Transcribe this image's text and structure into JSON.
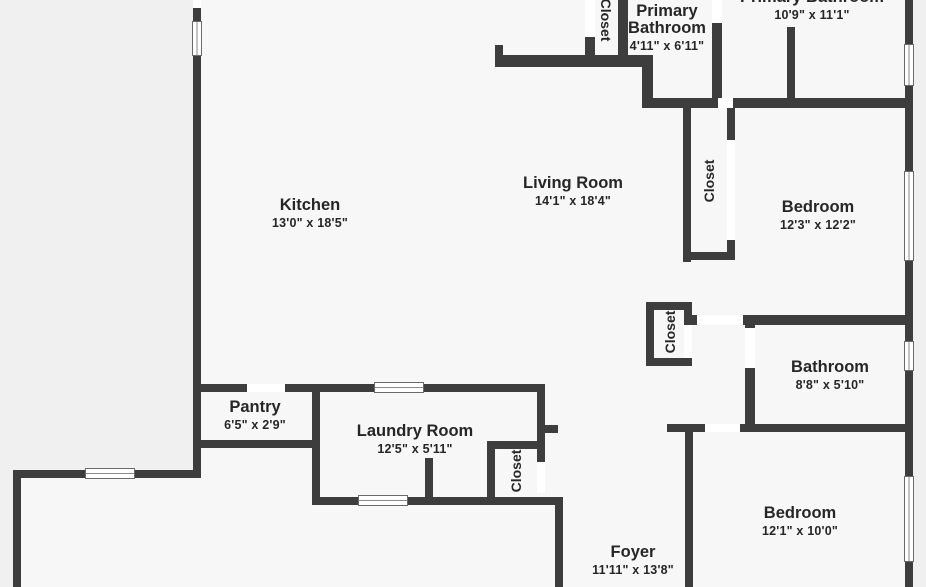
{
  "plan": {
    "colors": {
      "wall": "#3d3d3d",
      "floor": "#f7f7f7",
      "background": "#f0f0f0",
      "door_gap": "#ffffff",
      "window_frame": "#6a6a6a",
      "label_text": "#262626"
    },
    "floor_areas": [
      {
        "name": "floor-main",
        "x": 193,
        "y": 0,
        "w": 720,
        "h": 587
      },
      {
        "name": "floor-lower-left-extension",
        "x": 13,
        "y": 470,
        "w": 188,
        "h": 117
      }
    ],
    "rooms": [
      {
        "name": "room-label-kitchen",
        "lines": [
          "Kitchen"
        ],
        "dims": "13'0\" x 18'5\"",
        "cx": 310,
        "top": 197
      },
      {
        "name": "room-label-living-room",
        "lines": [
          "Living Room"
        ],
        "dims": "14'1\" x 18'4\"",
        "cx": 573,
        "top": 175
      },
      {
        "name": "room-label-primary-bathroom-small",
        "lines": [
          "Primary",
          "Bathroom"
        ],
        "dims": "4'11\" x 6'11\"",
        "cx": 667,
        "top": 3
      },
      {
        "name": "room-label-primary-bathroom-large",
        "lines": [
          "Primary Bathroom"
        ],
        "dims": "10'9\" x 11'1\"",
        "cx": 812,
        "top": -11
      },
      {
        "name": "room-label-bedroom-1",
        "lines": [
          "Bedroom"
        ],
        "dims": "12'3\" x 12'2\"",
        "cx": 818,
        "top": 199
      },
      {
        "name": "room-label-bathroom",
        "lines": [
          "Bathroom"
        ],
        "dims": "8'8\" x 5'10\"",
        "cx": 830,
        "top": 359
      },
      {
        "name": "room-label-bedroom-2",
        "lines": [
          "Bedroom"
        ],
        "dims": "12'1\" x 10'0\"",
        "cx": 800,
        "top": 505
      },
      {
        "name": "room-label-foyer",
        "lines": [
          "Foyer"
        ],
        "dims": "11'11\" x 13'8\"",
        "cx": 633,
        "top": 544
      },
      {
        "name": "room-label-pantry",
        "lines": [
          "Pantry"
        ],
        "dims": "6'5\" x 2'9\"",
        "cx": 255,
        "top": 399
      },
      {
        "name": "room-label-laundry-room",
        "lines": [
          "Laundry Room"
        ],
        "dims": "12'5\" x 5'11\"",
        "cx": 415,
        "top": 423
      }
    ],
    "closets": [
      {
        "name": "closet-label-top",
        "label": "Closet",
        "cx": 606,
        "cy": 20,
        "rotation": "cw"
      },
      {
        "name": "closet-label-hall",
        "label": "Closet",
        "cx": 709,
        "cy": 181,
        "rotation": "ccw"
      },
      {
        "name": "closet-label-middle",
        "label": "Closet",
        "cx": 670,
        "cy": 332,
        "rotation": "ccw"
      },
      {
        "name": "closet-label-laundry",
        "label": "Closet",
        "cx": 516,
        "cy": 471,
        "rotation": "ccw"
      }
    ],
    "walls": [
      {
        "name": "wall-left-upper-stub",
        "x": 193,
        "y": 8,
        "w": 8,
        "h": 14
      },
      {
        "name": "wall-left-main",
        "x": 193,
        "y": 55,
        "w": 8,
        "h": 423
      },
      {
        "name": "wall-exterior-bottom-left",
        "x": 13,
        "y": 470,
        "w": 188,
        "h": 8
      },
      {
        "name": "wall-exterior-far-left",
        "x": 13,
        "y": 470,
        "w": 8,
        "h": 117
      },
      {
        "name": "wall-right-exterior",
        "x": 905,
        "y": 0,
        "w": 8,
        "h": 587
      },
      {
        "name": "wall-top-closet-left",
        "x": 585,
        "y": 37,
        "w": 10,
        "h": 21
      },
      {
        "name": "wall-top-closet-right",
        "x": 618,
        "y": 0,
        "w": 10,
        "h": 57
      },
      {
        "name": "wall-primary-bath-divider-h",
        "x": 495,
        "y": 55,
        "w": 150,
        "h": 12
      },
      {
        "name": "wall-primary-bath-divider-stub",
        "x": 495,
        "y": 45,
        "w": 8,
        "h": 12
      },
      {
        "name": "wall-primary-bath-left",
        "x": 642,
        "y": 55,
        "w": 11,
        "h": 43
      },
      {
        "name": "wall-upper-h-1",
        "x": 642,
        "y": 98,
        "w": 76,
        "h": 10
      },
      {
        "name": "wall-upper-h-2",
        "x": 733,
        "y": 98,
        "w": 180,
        "h": 10
      },
      {
        "name": "wall-primary-suite-divider-1",
        "x": 712,
        "y": 23,
        "w": 10,
        "h": 75
      },
      {
        "name": "wall-primary-suite-divider-2",
        "x": 787,
        "y": 27,
        "w": 8,
        "h": 71
      },
      {
        "name": "wall-hall-closet-left",
        "x": 683,
        "y": 108,
        "w": 8,
        "h": 154
      },
      {
        "name": "wall-hall-closet-right-upper",
        "x": 727,
        "y": 108,
        "w": 8,
        "h": 32
      },
      {
        "name": "wall-hall-closet-right-lower",
        "x": 727,
        "y": 240,
        "w": 8,
        "h": 20
      },
      {
        "name": "wall-hall-closet-bottom",
        "x": 683,
        "y": 252,
        "w": 52,
        "h": 8
      },
      {
        "name": "wall-bedroom1-bottom-1",
        "x": 688,
        "y": 315,
        "w": 9,
        "h": 10
      },
      {
        "name": "wall-bedroom1-bottom-2",
        "x": 743,
        "y": 315,
        "w": 170,
        "h": 10
      },
      {
        "name": "wall-bathroom-left-upper",
        "x": 745,
        "y": 315,
        "w": 10,
        "h": 13
      },
      {
        "name": "wall-bathroom-left-lower",
        "x": 745,
        "y": 368,
        "w": 10,
        "h": 64
      },
      {
        "name": "wall-mid-closet-top",
        "x": 646,
        "y": 302,
        "w": 46,
        "h": 8
      },
      {
        "name": "wall-mid-closet-left",
        "x": 646,
        "y": 302,
        "w": 8,
        "h": 64
      },
      {
        "name": "wall-mid-closet-bottom",
        "x": 646,
        "y": 358,
        "w": 46,
        "h": 8
      },
      {
        "name": "wall-mid-closet-right-upper",
        "x": 684,
        "y": 302,
        "w": 8,
        "h": 23
      },
      {
        "name": "wall-bathroom-bottom-1",
        "x": 667,
        "y": 424,
        "w": 38,
        "h": 8
      },
      {
        "name": "wall-bathroom-bottom-2",
        "x": 740,
        "y": 424,
        "w": 173,
        "h": 8
      },
      {
        "name": "wall-bedroom2-left",
        "x": 685,
        "y": 432,
        "w": 8,
        "h": 155
      },
      {
        "name": "wall-kitchen-bottom-1",
        "x": 193,
        "y": 384,
        "w": 54,
        "h": 8
      },
      {
        "name": "wall-kitchen-bottom-2",
        "x": 285,
        "y": 384,
        "w": 90,
        "h": 8
      },
      {
        "name": "wall-kitchen-bottom-3",
        "x": 423,
        "y": 384,
        "w": 122,
        "h": 8
      },
      {
        "name": "wall-pantry-bottom",
        "x": 193,
        "y": 440,
        "w": 127,
        "h": 8
      },
      {
        "name": "wall-laundry-left",
        "x": 312,
        "y": 384,
        "w": 8,
        "h": 121
      },
      {
        "name": "wall-laundry-right-upper",
        "x": 537,
        "y": 384,
        "w": 8,
        "h": 78
      },
      {
        "name": "wall-laundry-bottom",
        "x": 312,
        "y": 497,
        "w": 251,
        "h": 8
      },
      {
        "name": "wall-laundry-stub",
        "x": 425,
        "y": 458,
        "w": 8,
        "h": 47
      },
      {
        "name": "wall-laundry-closet-top",
        "x": 487,
        "y": 441,
        "w": 58,
        "h": 8
      },
      {
        "name": "wall-laundry-closet-left",
        "x": 487,
        "y": 441,
        "w": 8,
        "h": 64
      },
      {
        "name": "wall-foyer-stub",
        "x": 537,
        "y": 425,
        "w": 21,
        "h": 8
      },
      {
        "name": "wall-foyer-left",
        "x": 555,
        "y": 497,
        "w": 8,
        "h": 90
      }
    ],
    "doors": [
      {
        "name": "door-gap-left-wall-top",
        "x": 193,
        "y": 0,
        "w": 8,
        "h": 8
      },
      {
        "name": "door-gap-top-closet",
        "x": 585,
        "y": 0,
        "w": 10,
        "h": 37
      },
      {
        "name": "door-gap-primary-suite-top",
        "x": 712,
        "y": 0,
        "w": 10,
        "h": 23
      },
      {
        "name": "door-gap-upper-hall",
        "x": 718,
        "y": 98,
        "w": 15,
        "h": 10
      },
      {
        "name": "door-gap-hall-closet",
        "x": 727,
        "y": 140,
        "w": 8,
        "h": 100
      },
      {
        "name": "door-gap-bedroom1",
        "x": 697,
        "y": 315,
        "w": 46,
        "h": 10
      },
      {
        "name": "door-gap-bathroom",
        "x": 745,
        "y": 328,
        "w": 10,
        "h": 40
      },
      {
        "name": "door-gap-mid-closet",
        "x": 684,
        "y": 325,
        "w": 8,
        "h": 33
      },
      {
        "name": "door-gap-bedroom2",
        "x": 705,
        "y": 424,
        "w": 35,
        "h": 8
      },
      {
        "name": "door-gap-pantry",
        "x": 247,
        "y": 384,
        "w": 38,
        "h": 8
      },
      {
        "name": "door-gap-laundry-closet",
        "x": 537,
        "y": 462,
        "w": 8,
        "h": 31
      }
    ],
    "windows": [
      {
        "name": "window-left-wall",
        "x": 192,
        "y": 21,
        "w": 10,
        "h": 35,
        "orient": "v"
      },
      {
        "name": "window-bottom-left",
        "x": 85,
        "y": 468,
        "w": 50,
        "h": 11,
        "orient": "h"
      },
      {
        "name": "window-right-top",
        "x": 904,
        "y": 44,
        "w": 10,
        "h": 42,
        "orient": "v"
      },
      {
        "name": "window-right-bedroom1",
        "x": 904,
        "y": 171,
        "w": 10,
        "h": 90,
        "orient": "v"
      },
      {
        "name": "window-right-bathroom",
        "x": 904,
        "y": 341,
        "w": 10,
        "h": 30,
        "orient": "v"
      },
      {
        "name": "window-right-bedroom2",
        "x": 904,
        "y": 476,
        "w": 10,
        "h": 86,
        "orient": "v"
      },
      {
        "name": "window-laundry-top",
        "x": 374,
        "y": 382,
        "w": 50,
        "h": 11,
        "orient": "h"
      },
      {
        "name": "window-laundry-bottom",
        "x": 358,
        "y": 495,
        "w": 50,
        "h": 11,
        "orient": "h"
      }
    ]
  }
}
